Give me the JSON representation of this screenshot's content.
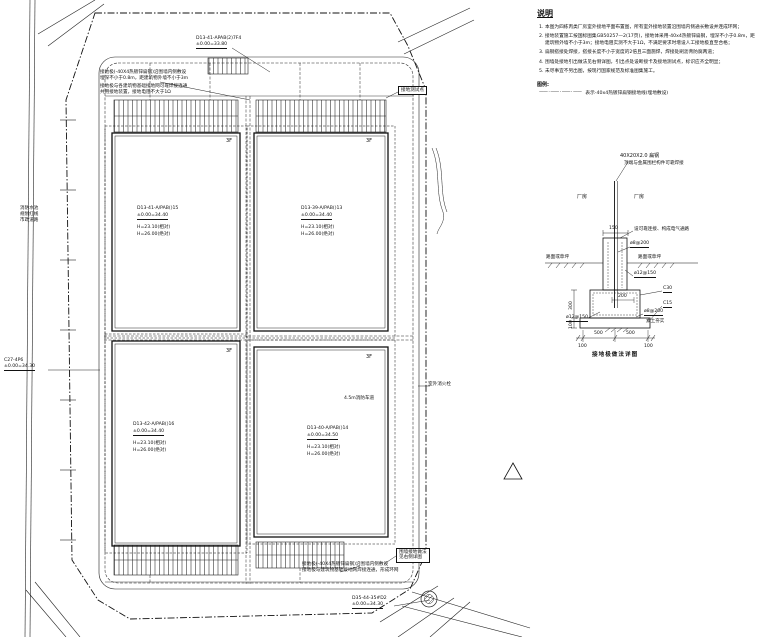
{
  "plan": {
    "buildings": [
      {
        "floors": "3F",
        "id": "D13-41-A/PAB()15",
        "elev": "±0.00=34.40",
        "h_rel": "H=23.10(相对)",
        "h_abs": "H=26.00(绝对)"
      },
      {
        "floors": "3F",
        "id": "D13-39-A/PAB()13",
        "elev": "±0.00=34.40",
        "h_rel": "H=23.10(相对)",
        "h_abs": "H=26.00(绝对)"
      },
      {
        "floors": "3F",
        "id": "D13-42-A/PAB()16",
        "elev": "±0.00=34.40",
        "h_rel": "H=23.10(相对)",
        "h_abs": "H=26.00(绝对)"
      },
      {
        "floors": "3F",
        "id": "D13-40-A/PAB()14",
        "elev": "±0.00=34.50",
        "h_rel": "H=23.10(相对)",
        "h_abs": "H=26.00(绝对)"
      }
    ],
    "callouts": {
      "top_id": "D13-41-APAB(2)7F4",
      "top_elev": "±0.00=33.80",
      "left_id": "C27-4P6",
      "left_elev": "±0.00=34.30",
      "bottom_id": "D35-44-35#D2",
      "bottom_elev": "±0.00=34.30"
    },
    "annotations": {
      "top1": "接地极(-40X4热镀锌扁钢)沿围墙内侧敷设",
      "top1b": "埋深不小于0.8m，距建筑物外墙不小于3m",
      "top2": "接地极与各建筑物基础接地网可靠焊接连通",
      "top2b": "共用接地装置，接地电阻不大于1Ω",
      "bottom1": "接地极(-40X4热镀锌扁钢)沿围墙内侧敷设",
      "bottom1b": "接地极与建筑物基础接地网焊接连通，形成环网",
      "corner1": "围墙接地做法",
      "corner2": "见右侧详图",
      "test_point": "接地测试点",
      "hydrant": "室外消火栓",
      "fire_lane": "4.5m消防车道",
      "left_labels": [
        "消防水池",
        "规划红线",
        "市政道路"
      ]
    }
  },
  "notes_panel": {
    "title": "说明",
    "notes": [
      "本图为四栋丙类厂房室外接地平面布置图，所有室外接地装置沿围墙内侧通长敷设并连成环网；",
      "接地装置施工按国标图集GB50257—2(17页)，接地体采用-40x4热镀锌扁钢，埋深不小于0.8m，距建筑物外墙不小于3m；接地电阻实测不大于1Ω，不满足要求时增设人工接地极直至合格；",
      "扁钢搭接处焊接，搭接长度不小于宽度的2倍且三面施焊，焊接处刷沥青防腐两道；",
      "围墙处接地引出做法见右侧详图，引出点处设断接卡及接地测试点，标识应齐全明显；",
      "未尽事宜不另出图，按现行国家规范及标准图集施工。"
    ],
    "legend_title": "图例:",
    "legend_symbol": "—— · —— · —— · ——",
    "legend_label": "表示-40x4热镀锌扁钢接地线(埋地敷设)"
  },
  "detail": {
    "pole_spec": "40X20X2.0 扁钢",
    "pole_note": "顶端与金属围栏构件可靠焊接",
    "room_left": "厂房",
    "room_right": "厂房",
    "dim_150": "150",
    "conn_note": "设可靠连接、构成电气通路",
    "rebar_top": "ø8@200",
    "ground_left": "路面或草坪",
    "ground_right": "路面或草坪",
    "rebar_mid": "ø12@150",
    "c30": "C30",
    "dim_200": "200",
    "c15": "C15",
    "rebar_bottom_left": "ø12@150",
    "rebar_bottom_right": "ø8@200",
    "soil": "素土夯实",
    "dim_300": "300",
    "dim_100_left": "100",
    "dim_500_a": "500",
    "dim_500_b": "500",
    "dim_100_a": "100",
    "dim_100_b": "100",
    "caption": "接地极做法详图"
  }
}
